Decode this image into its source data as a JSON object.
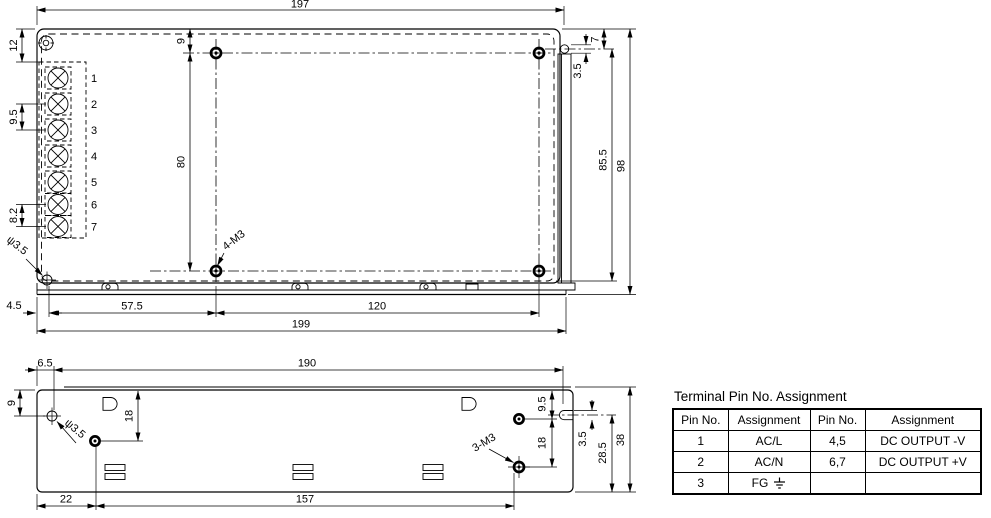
{
  "top_view": {
    "dims": {
      "top_width": "197",
      "left_offset": "12",
      "pin_pitch": "9.5",
      "pin_pitch_small": "8.2",
      "hole_top_offset": "9",
      "hole_span_vertical": "80",
      "notch_width": "3.5",
      "notch_top_offset": "7",
      "side_height_inner": "85.5",
      "side_height": "98",
      "corner_hole_offset": "4.5",
      "hole_col_1": "57.5",
      "hole_col_2": "120",
      "bottom_width": "199",
      "corner_hole_dia": "ψ3.5",
      "mounting_holes": "4-M3"
    },
    "pin_numbers": [
      "1",
      "2",
      "3",
      "4",
      "5",
      "6",
      "7"
    ]
  },
  "bottom_view": {
    "dims": {
      "hole_left_offset": "6.5",
      "top_width": "190",
      "hole_top_offset": "9",
      "hole_down": "18",
      "bottom_seg_1": "22",
      "bottom_seg_2": "157",
      "right_top": "9.5",
      "right_mid": "18",
      "notch_width": "3.5",
      "right_lower": "28.5",
      "height": "38",
      "corner_hole_dia": "ψ3.5",
      "mounting_holes": "3-M3"
    }
  },
  "table": {
    "title": "Terminal Pin No. Assignment",
    "headers": [
      "Pin No.",
      "Assignment",
      "Pin No.",
      "Assignment"
    ],
    "rows": [
      {
        "pin": "1",
        "assignment": "AC/L",
        "pin2": "4,5",
        "assignment2": "DC OUTPUT -V"
      },
      {
        "pin": "2",
        "assignment": "AC/N",
        "pin2": "6,7",
        "assignment2": "DC OUTPUT +V"
      },
      {
        "pin": "3",
        "assignment": "FG",
        "pin2": "",
        "assignment2": ""
      }
    ],
    "ground_icon": "earth-ground"
  },
  "colors": {
    "line": "#000000",
    "background": "#ffffff"
  }
}
